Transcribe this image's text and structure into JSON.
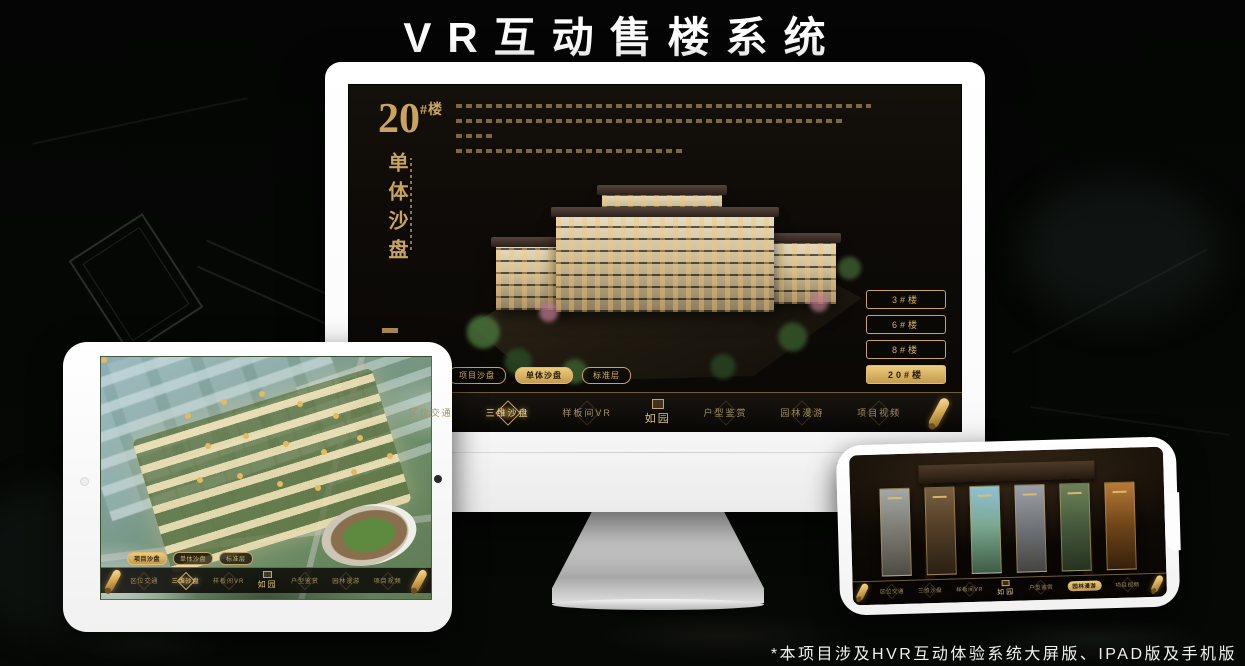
{
  "header": {
    "title": "VR互动售楼系统"
  },
  "footer": {
    "note": "*本项目涉及HVR互动体验系统大屏版、IPAD版及手机版"
  },
  "logo": {
    "text": "如园"
  },
  "tabs": [
    {
      "label": "项目沙盘"
    },
    {
      "label": "单体沙盘"
    },
    {
      "label": "标准层"
    }
  ],
  "nav": {
    "items": [
      {
        "label": "区位交通"
      },
      {
        "label": "三维沙盘"
      },
      {
        "label": "样板间VR"
      },
      {
        "label": "户型鉴赏"
      },
      {
        "label": "园林漫游"
      },
      {
        "label": "项目视频"
      }
    ]
  },
  "desktop": {
    "block_number": "20",
    "block_suffix": "#楼",
    "block_subtitle": "单体沙盘",
    "floor_buttons": [
      {
        "label": "3#楼"
      },
      {
        "label": "6#楼"
      },
      {
        "label": "8#楼"
      },
      {
        "label": "20#楼"
      }
    ],
    "active_tab": "单体沙盘",
    "active_nav": "三维沙盘",
    "active_floor": "20#楼"
  },
  "tablet": {
    "active_tab": "项目沙盘",
    "active_nav": "三维沙盘"
  },
  "phone": {
    "active_nav": "园林漫游"
  },
  "colors": {
    "gold": "#c9a35f",
    "gold_bright": "#e8c377",
    "screen_bg": "#0d0a07",
    "frame_white": "#ffffff"
  }
}
